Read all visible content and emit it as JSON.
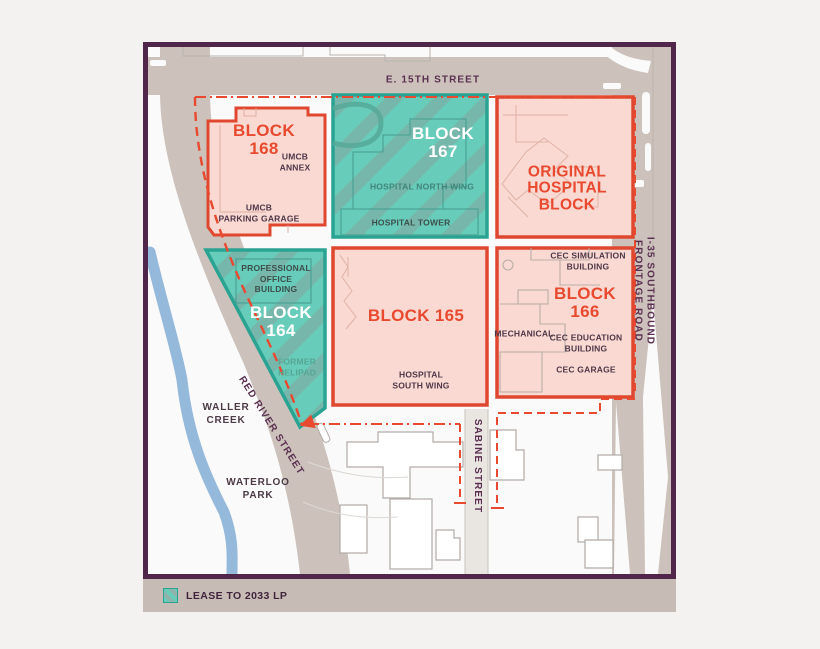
{
  "legend": {
    "label": "LEASE TO 2033 LP"
  },
  "streets": {
    "e15th": "E. 15TH STREET",
    "i35": "I-35 SOUTHBOUND FRONTAGE ROAD",
    "red_river": "RED RIVER STREET",
    "sabine": "SABINE STREET"
  },
  "landmarks": {
    "waller_creek": "WALLER\nCREEK",
    "waterloo_park": "WATERLOO\nPARK"
  },
  "blocks": {
    "block168": {
      "title": "BLOCK\n168",
      "annex": "UMCB\nANNEX",
      "garage": "UMCB\nPARKING GARAGE"
    },
    "block167": {
      "title": "BLOCK\n167",
      "north_wing": "HOSPITAL NORTH WING",
      "tower": "HOSPITAL TOWER"
    },
    "original": {
      "title": "ORIGINAL\nHOSPITAL\nBLOCK"
    },
    "block164": {
      "title": "BLOCK\n164",
      "office": "PROFESSIONAL\nOFFICE\nBUILDING",
      "helipad": "FORMER\nHELIPAD"
    },
    "block165": {
      "title": "BLOCK 165",
      "south_wing": "HOSPITAL\nSOUTH WING"
    },
    "block166": {
      "title": "BLOCK\n166",
      "simulation": "CEC SIMULATION\nBUILDING",
      "mechanical": "MECHANICAL",
      "education": "CEC EDUCATION\nBUILDING",
      "garage": "CEC GARAGE"
    }
  },
  "colors": {
    "frame_purple": "#50264a",
    "street_tan": "#ccc2bb",
    "teal_fill": "#68ccba",
    "teal_border": "#2aa392",
    "pink_fill": "#f9d9d1",
    "red_border": "#e0472f",
    "red_text": "#e8492f",
    "creek_blue": "#95b9da",
    "legend_strip": "#c7bcb5"
  }
}
